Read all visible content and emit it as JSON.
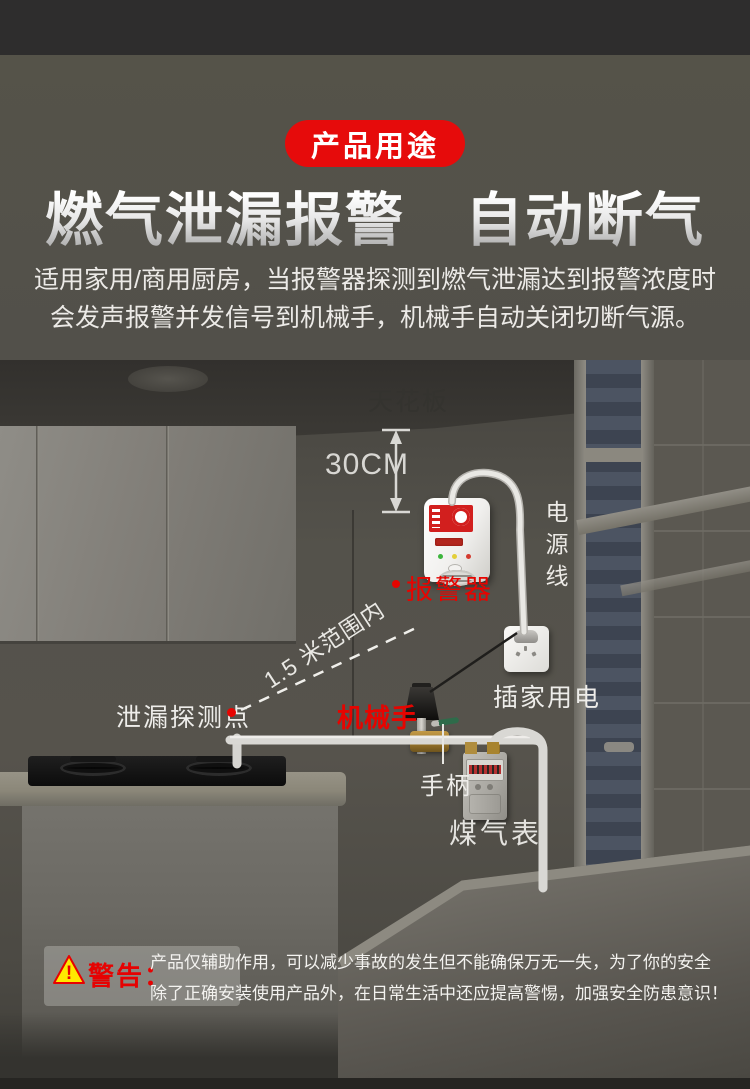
{
  "header": {
    "badge": "产品用途",
    "title": "燃气泄漏报警　自动断气",
    "subtitle_line1": "适用家用/商用厨房，当报警器探测到燃气泄漏达到报警浓度时",
    "subtitle_line2": "会发声报警并发信号到机械手，机械手自动关闭切断气源。"
  },
  "diagram": {
    "labels": {
      "ceiling": "天花板",
      "distance": "30CM",
      "power_cord": "电源线",
      "alarm": "报警器",
      "socket": "插家用电",
      "detection_point": "泄漏探测点",
      "range": "1.5 米范围内",
      "manipulator": "机械手",
      "handle": "手柄",
      "gas_meter": "煤气表"
    },
    "icons": [
      "warning-triangle-icon",
      "distance-arrow-icon",
      "marker-dot-icon",
      "dashed-range-line"
    ]
  },
  "warning": {
    "label": "警告：",
    "line1": "产品仅辅助作用，可以减少事故的发生但不能确保万无一失，为了你的安全",
    "line2": "除了正确安装使用产品外，在日常生活中还应提高警惕，加强安全防患意识！"
  },
  "colors": {
    "accent_red": "#e60b0b",
    "annotation_red": "#e60400",
    "warning_yellow": "#ffe900",
    "header_bg": "#52504a",
    "top_bar": "#2e2d2d",
    "pipe": "#dddcd8"
  }
}
